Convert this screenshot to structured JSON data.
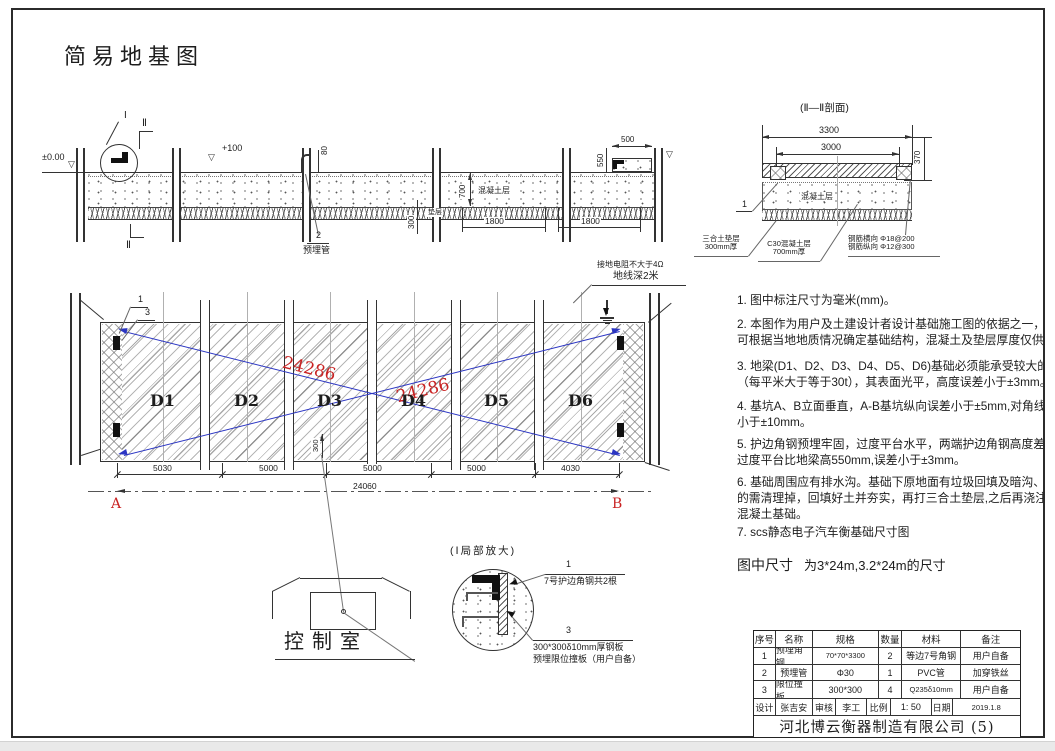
{
  "colors": {
    "line": "#333333",
    "red": "#c92323",
    "blue": "#2b35c2"
  },
  "sheet_title": "简易地基图",
  "long_section": {
    "level_zero": "±0.00",
    "level_plus": "+100",
    "level_mark": "▽",
    "detail_mark": "I",
    "section_mark_top": "Ⅱ",
    "section_mark_bottom": "Ⅱ",
    "pipe_height_dim": "80",
    "pipe_item_no": "2",
    "pipe_label": "预埋管",
    "concrete_depth_dim": "700",
    "concrete_label": "混凝土层",
    "cushion_label": "垫层",
    "cushion_depth_dim": "300",
    "bay_dim_1": "1800",
    "bay_dim_2": "1800",
    "end_width_dim": "500",
    "end_height_dim": "550"
  },
  "section_ii": {
    "title": "(Ⅱ—Ⅱ剖面)",
    "outer_width_dim": "3300",
    "inner_width_dim": "3000",
    "height_dim": "370",
    "leader_no": "1",
    "concrete_label": "混凝土层",
    "cushion_note": "三合土垫层\n300mm厚",
    "concrete_note": "C30混凝土层\n700mm厚",
    "rebar_note": "钢筋横向 Φ18@200\n钢筋纵向 Φ12@300"
  },
  "notes": [
    "1. 图中标注尺寸为毫米(mm)。",
    "2. 本图作为用户及土建设计者设计基础施工图的依据之一，用户\n可根据当地地质情况确定基础结构，混凝土及垫层厚度仅供参",
    "3. 地梁(D1、D2、D3、D4、D5、D6)基础必须能承受较大的冲击和\n（每平米大于等于30t），其表面光平，高度误差小于±3mm。",
    "4. 基坑A、B立面垂直，A-B基坑纵向误差小于±5mm,对角线误差\n小于±10mm。",
    "5. 护边角钢预埋牢固，过度平台水平，两端护边角钢高度差<4mm\n过度平台比地梁高550mm,误差小于±3mm。",
    "6. 基础周围应有排水沟。基础下原地面有垃圾回填及暗沟、暗管\n的需清理掉，回填好土并夯实，再打三合土垫层,之后再浇注\n混凝土基础。",
    "7. scs静态电子汽车衡基础尺寸图"
  ],
  "size_note": {
    "label": "图中尺寸",
    "value": "为3*24m,3.2*24m的尺寸"
  },
  "plan": {
    "blocks": [
      "D1",
      "D2",
      "D3",
      "D4",
      "D5",
      "D6"
    ],
    "diag_dim_1": "24286",
    "diag_dim_2": "24286",
    "leader_no_1": "1",
    "leader_no_3": "3",
    "pipe_offset_dim": "300",
    "seg_dims": [
      "5030",
      "5000",
      "5000",
      "5000",
      "4030"
    ],
    "total_dim": "24060",
    "point_a": "A",
    "point_b": "B",
    "ground_note_1": "接地电阻不大于4Ω",
    "ground_note_2": "地线深2米"
  },
  "control_room": {
    "label": "控制室"
  },
  "detail_i": {
    "title": "(Ⅰ局部放大)",
    "leader1_no": "1",
    "leader1_text": "7号护边角钢共2根",
    "leader3_no": "3",
    "leader3_text_1": "300*300δ10mm厚钢板",
    "leader3_text_2": "预埋限位撞板（用户自备）"
  },
  "bom": {
    "headers": [
      "序号",
      "名称",
      "规格",
      "数量",
      "材料",
      "备注"
    ],
    "rows": [
      [
        "1",
        "预埋角钢",
        "70*70*3300",
        "2",
        "等边7号角钢",
        "用户自备"
      ],
      [
        "2",
        "预埋管",
        "Φ30",
        "1",
        "PVC管",
        "加穿铁丝"
      ],
      [
        "3",
        "限位撞板",
        "300*300",
        "4",
        "Q235δ10mm",
        "用户自备"
      ]
    ],
    "sign": {
      "design_label": "设计",
      "designer": "张吉安",
      "audit_label": "审核",
      "auditor": "李工",
      "scale_label": "比例",
      "scale": "1: 50",
      "date_label": "日期",
      "date": "2019.1.8"
    },
    "company": "河北博云衡器制造有限公司 (5)"
  }
}
